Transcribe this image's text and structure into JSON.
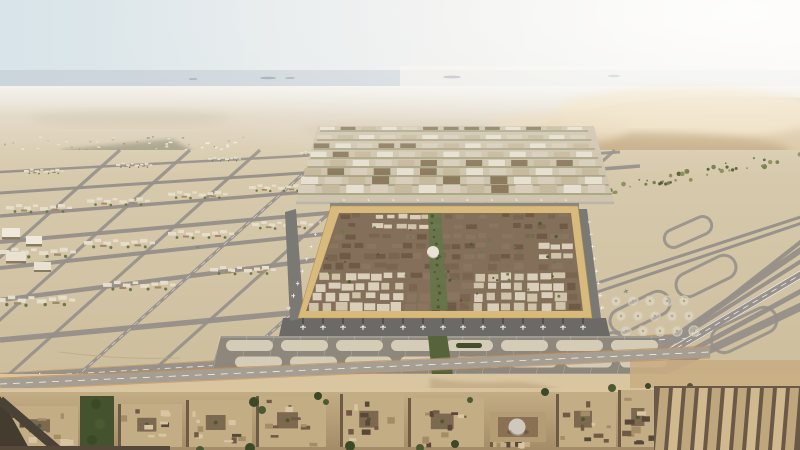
{
  "meta": {
    "type": "architectural-aerial-render",
    "subject": "Aerial CGI render of a vast desert airport masterplan with a square terminal-city at its center",
    "setting": "flat desert plain, hazy mirage horizon, soft dunes to the right",
    "lighting": "hazy daylight, bright glare from the upper right",
    "text_visible": "none"
  },
  "palette": {
    "sky_left": "#d8e4ea",
    "sky_mid": "#edeeec",
    "sky_right": "#f8f5ef",
    "haze": "#c6cfd5",
    "island": "#8f9aa3",
    "far_top": "#e0d9ca",
    "far_bottom": "#d8c9ab",
    "dune_base": "#d2b98e",
    "dune_light": "#ecd9b2",
    "dune_shadow": "#b2925f",
    "dune_deep": "#a5855a",
    "sand_top": "#d8cbae",
    "sand_bottom": "#c9ba97",
    "taxi": "#96908a",
    "taxi_light": "#b8b2a7",
    "line_white": "#ffffff",
    "line_orange": "#d4893c",
    "veg_dark": "#4d5a31",
    "veg_mid": "#6d7845",
    "cluster_roof": "#e6decb",
    "cluster_dark": "#a08a68",
    "district_light": "#e7e0d1",
    "district_mid": "#d8cebb",
    "district_deep": "#c7b99d",
    "district_dark": "#8d7b60",
    "frame_gold": "#d9ba7d",
    "frame_edge": "#b5914f",
    "city_base": "#84705a",
    "roof_dark": "#6e5a45",
    "roof_mid": "#8a7660",
    "roof_cream": "#d9cfba",
    "roof_cream2": "#cfc4aa",
    "boulevard": "#66744a",
    "dome": "#eae3d3",
    "apron": "#6b6a66",
    "apron_side": "#7b7973",
    "bridge": "#4d4b47",
    "oval_band": "#8e887c",
    "oval_pad": "#d9d0bb",
    "oval_green": "#424d2b",
    "fg_sand": "#d9c6a1",
    "fg_sand_warm": "#c9ad83",
    "block_top": "#c3ad85",
    "block_mid": "#a58c68",
    "block_side": "#6e5b44",
    "block_gap": "#57483a",
    "warehouse_light": "#d0b98f",
    "warehouse_mid": "#bfa77d",
    "warehouse_shadow": "#6b5947",
    "road_dark": "#453c30",
    "plane": "#f4f3f0",
    "plane_dark": "#6a675f"
  },
  "scene": {
    "sky": {
      "description": "pale hazy sky, brighter toward the right",
      "islands": 5
    },
    "horizon": {
      "description": "gray-blue mirage band with tiny distant landforms"
    },
    "dunes": {
      "description": "soft dunes upper right with diagonal band of scattered green vegetation",
      "vegetation_dots": 74
    },
    "airfield": {
      "description": "lattice of gray taxiways over sand at left; parallel runways receding to the right with loop connectors",
      "lattice_lines_a": 8,
      "lattice_lines_b": 8,
      "runways_right": 8,
      "loop_connectors": 5,
      "circle_pad_rows": 3,
      "circle_pad_cols": 5,
      "settlement_specks": 40,
      "settlement_cluster": 14
    },
    "district": {
      "description": "gridded mid-rise district behind the square terminal",
      "rows": 8,
      "blocks_per_row": 13
    },
    "terminal_square": {
      "description": "square terminal-city with golden rim, dense brown roofs, cream roof clusters, green central boulevard, white dome, aircraft docked on all four sides",
      "planes_bottom": 15,
      "planes_left": 8,
      "planes_right": 8,
      "planes_top": 10,
      "roof_rows": 10,
      "roof_cols": 20,
      "tree_dots": 46,
      "dome": true
    },
    "stands": {
      "description": "double row of stadium-shaped aircraft stand pads below the square",
      "rows": 2,
      "ovals_per_row": 8,
      "planted_ovals": 2
    },
    "foreground": {
      "description": "low flat-roofed blocks with courtyards and trees, a small domed pavilion, slanted warehouse rows at the right, dark road lower left",
      "blocks": 9,
      "warehouse_slats": 11,
      "taxiing_planes": 3
    }
  }
}
